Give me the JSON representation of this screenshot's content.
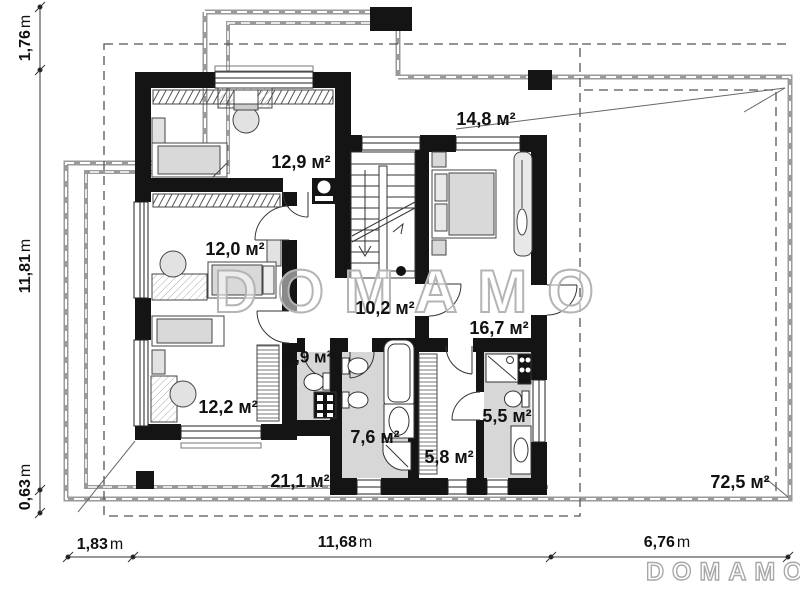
{
  "watermark": {
    "center": "DOMAMO",
    "corner": "DOMAMO"
  },
  "rooms": [
    {
      "id": "bedroom-1",
      "label": "12,9 м²"
    },
    {
      "id": "balcony",
      "label": "14,8 м²"
    },
    {
      "id": "bedroom-2",
      "label": "12,0 м²"
    },
    {
      "id": "hall",
      "label": "10,2 м²"
    },
    {
      "id": "bedroom-4",
      "label": "16,7 м²"
    },
    {
      "id": "bedroom-3",
      "label": "12,2 м²"
    },
    {
      "id": "wc",
      "label": "2,9 м²"
    },
    {
      "id": "bathroom-1",
      "label": "7,6 м²"
    },
    {
      "id": "wardrobe",
      "label": "5,8 м²"
    },
    {
      "id": "bathroom-2",
      "label": "5,5 м²"
    },
    {
      "id": "terrace",
      "label": "21,1 м²"
    },
    {
      "id": "roof",
      "label": "72,5 м²"
    }
  ],
  "dimensions": {
    "left": [
      {
        "value": "1,76",
        "unit": "m"
      },
      {
        "value": "11,81",
        "unit": "m"
      },
      {
        "value": "0,63",
        "unit": "m"
      }
    ],
    "bottom": [
      {
        "value": "1,83",
        "unit": "m"
      },
      {
        "value": "11,68",
        "unit": "m"
      },
      {
        "value": "6,76",
        "unit": "m"
      }
    ]
  }
}
